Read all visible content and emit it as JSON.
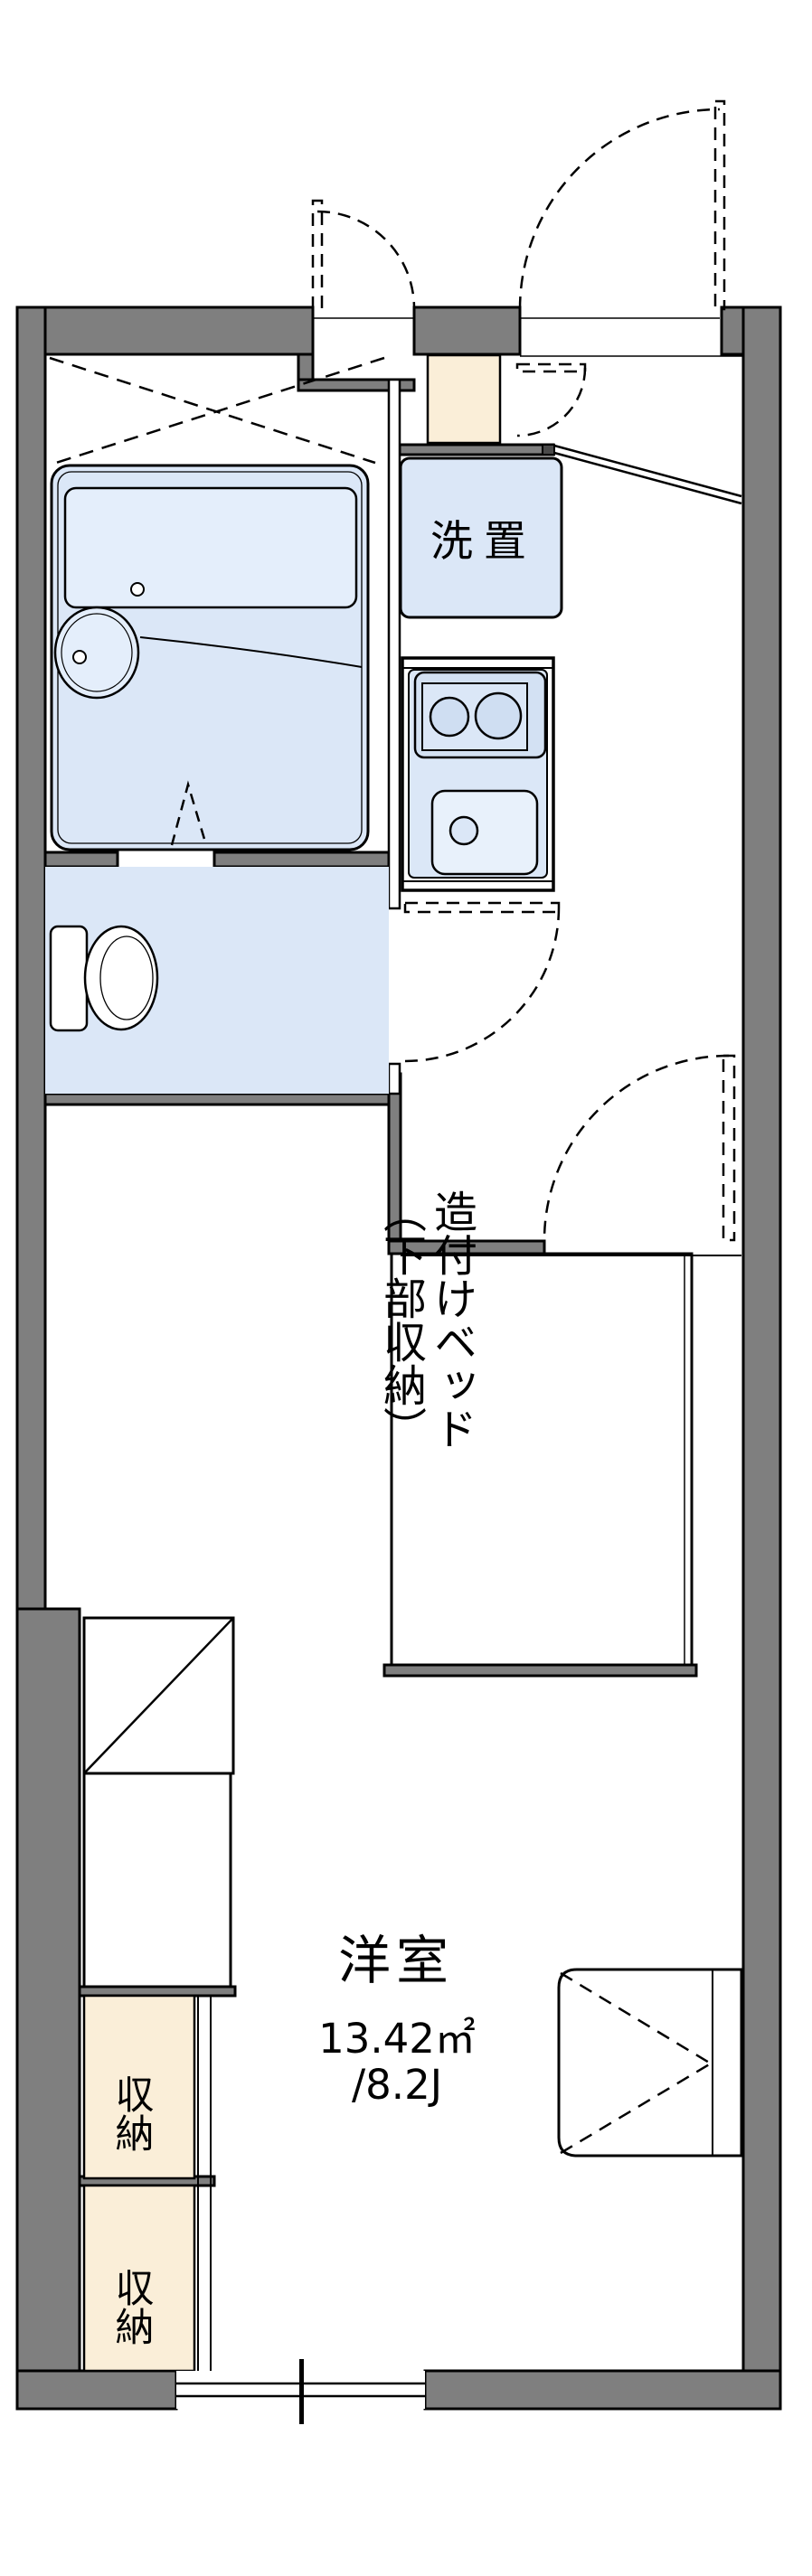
{
  "document": {
    "type": "apartment-floor-plan",
    "orientation": "portrait"
  },
  "labels": {
    "washer_space": "洗置",
    "built_in_bed_line1": "造付けベッド",
    "built_in_bed_line2": "（下部収納）",
    "western_room": "洋室",
    "room_area_m2": "13.42㎡",
    "room_area_jo": "/8.2J",
    "storage_upper": "収納",
    "storage_lower": "収納"
  },
  "rooms": [
    {
      "name": "bathroom-unit-bath",
      "fixtures": [
        "bathtub",
        "wash-basin"
      ]
    },
    {
      "name": "toilet-room",
      "fixtures": [
        "toilet"
      ]
    },
    {
      "name": "washer-space",
      "label": "洗置"
    },
    {
      "name": "kitchen",
      "fixtures": [
        "two-burner-stove",
        "sink"
      ]
    },
    {
      "name": "entrance-genkan"
    },
    {
      "name": "built-in-bed",
      "label": "造付けベッド（下部収納）"
    },
    {
      "name": "western-room",
      "label": "洋室",
      "area_m2": "13.42㎡",
      "area_jo": "/8.2J"
    },
    {
      "name": "storage-closet-1",
      "label": "収納"
    },
    {
      "name": "storage-closet-2",
      "label": "収納"
    }
  ],
  "colors": {
    "wall_fill": "#7f7f7f",
    "wall_dark_cap": "#4a4a4a",
    "outline": "#000000",
    "fixture_blue": "#dbe7f7",
    "fixture_blue_light": "#e8f1fb",
    "floor_cream": "#faeed8",
    "background": "#ffffff"
  }
}
